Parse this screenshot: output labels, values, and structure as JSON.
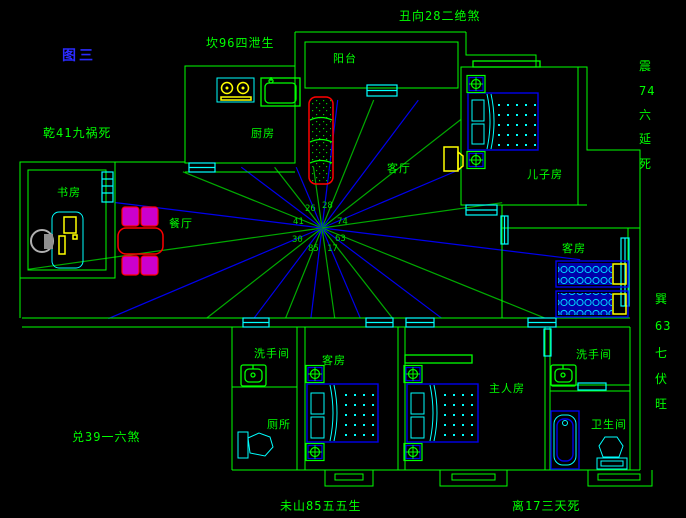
{
  "title": {
    "figure_label": "图三"
  },
  "perimeter_labels": {
    "top": "丑向28二绝煞",
    "top_left": "坎96四泄生",
    "left_upper": "乾41九祸死",
    "left_lower": "兑39一六煞",
    "bottom_left": "未山85五五生",
    "bottom_right": "离17三天死",
    "right_upper": [
      "震",
      "74",
      "六",
      "延",
      "死"
    ],
    "right_lower": [
      "巽",
      "63",
      "七",
      "伏",
      "旺"
    ]
  },
  "rooms": {
    "balcony": "阳台",
    "kitchen": "厨房",
    "living": "客厅",
    "son_room": "儿子房",
    "study": "书房",
    "dining": "餐厅",
    "guest_upper": "客房",
    "wash_left": "洗手间",
    "guest_lower": "客房",
    "toilet": "厕所",
    "master": "主人房",
    "wash_right": "洗手间",
    "bathroom": "卫生间"
  },
  "compass": {
    "numbers": [
      "26",
      "28",
      "41",
      "74",
      "30",
      "63",
      "85",
      "17"
    ]
  },
  "colors": {
    "wall_green": "#00ff00",
    "window_cyan": "#00ffff",
    "furniture_blue": "#0000ee",
    "line_blue": "#0000ee",
    "line_green": "#00aa00",
    "accent_red": "#ff0000",
    "accent_magenta": "#cc00cc",
    "accent_yellow": "#ffff00",
    "title_blue": "#2b2bff"
  }
}
